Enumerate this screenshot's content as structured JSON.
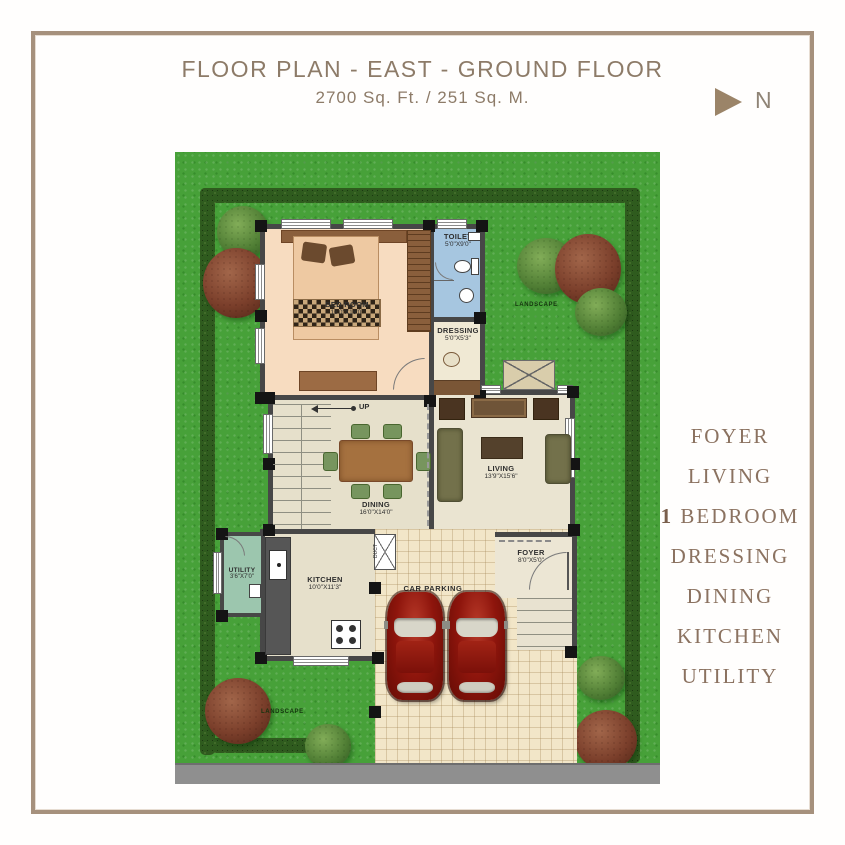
{
  "header": {
    "title": "FLOOR PLAN - EAST - GROUND FLOOR",
    "subtitle": "2700 Sq. Ft. / 251 Sq. M."
  },
  "compass": {
    "label": "N"
  },
  "legend": {
    "items": [
      "FOYER",
      "LIVING",
      "1 BEDROOM",
      "DRESSING",
      "DINING",
      "KITCHEN",
      "UTILITY"
    ]
  },
  "rooms": {
    "bedroom": {
      "name": "BED ROOM",
      "dims": "16'0\"X16'0\""
    },
    "toilet": {
      "name": "TOILET",
      "dims": "5'0\"X9'0\""
    },
    "dressing": {
      "name": "DRESSING",
      "dims": "5'0\"X5'3\""
    },
    "dining": {
      "name": "DINING",
      "dims": "16'0\"X14'0\""
    },
    "living": {
      "name": "LIVING",
      "dims": "13'9\"X15'6\""
    },
    "kitchen": {
      "name": "KITCHEN",
      "dims": "10'0\"X11'3\""
    },
    "utility": {
      "name": "UTILITY",
      "dims": "3'6\"X7'0\""
    },
    "foyer": {
      "name": "FOYER",
      "dims": "8'0\"X5'0\""
    },
    "car_parking": {
      "name": "CAR PARKING"
    },
    "duct": {
      "name": "DUCT"
    }
  },
  "site": {
    "landscape_label": "LANDSCAPE",
    "stairs_label": "UP"
  },
  "colors": {
    "accent_tan": "#a6917d",
    "title_text": "#8d7b68",
    "legend_text": "#8b7260",
    "grass": "#47a139",
    "hedge": "#2f5b1e",
    "wall": "#474747",
    "bedroom_floor": "#f7dcc0",
    "toilet_floor": "#a6c6e0",
    "utility_floor": "#9cc6ae",
    "parking_floor": "#f2e6c8",
    "car_red": "#8e150c",
    "road": "#8f8f8f"
  }
}
